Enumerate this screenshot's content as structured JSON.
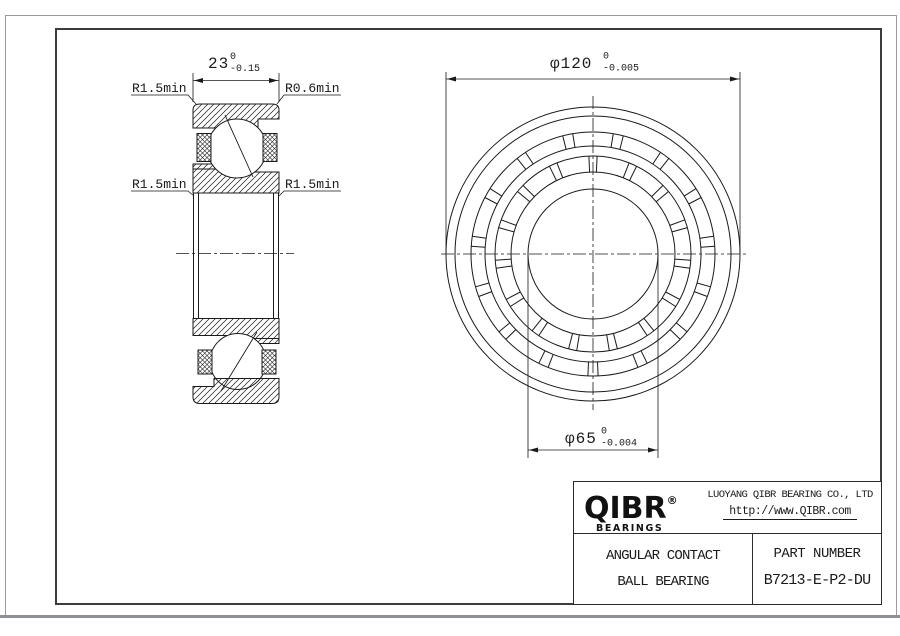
{
  "section_view": {
    "width_dim": {
      "value": "23",
      "tol_upper": "0",
      "tol_lower": "-0.15"
    },
    "label_top_left": "R1.5min",
    "label_top_right": "R0.6min",
    "label_mid_left": "R1.5min",
    "label_mid_right": "R1.5min"
  },
  "front_view": {
    "od_dim": {
      "value": "φ120",
      "tol_upper": "0",
      "tol_lower": "-0.005"
    },
    "bore_dim": {
      "value": "φ65",
      "tol_upper": "0",
      "tol_lower": "-0.004"
    }
  },
  "title_block": {
    "brand": "QIBR",
    "brand_mark": "®",
    "brand_sub": "BEARINGS",
    "company": "LUOYANG QIBR BEARING CO., LTD",
    "website": "http://www.QIBR.com",
    "product_line1": "ANGULAR CONTACT",
    "product_line2": "BALL BEARING",
    "part_number_label": "PART NUMBER",
    "part_number": "B7213-E-P2-DU"
  },
  "colors": {
    "line": "#1a1a1a",
    "frame_inner": "#3c3c3c",
    "frame_outer": "#9a9a9a",
    "paper": "#ffffff"
  }
}
